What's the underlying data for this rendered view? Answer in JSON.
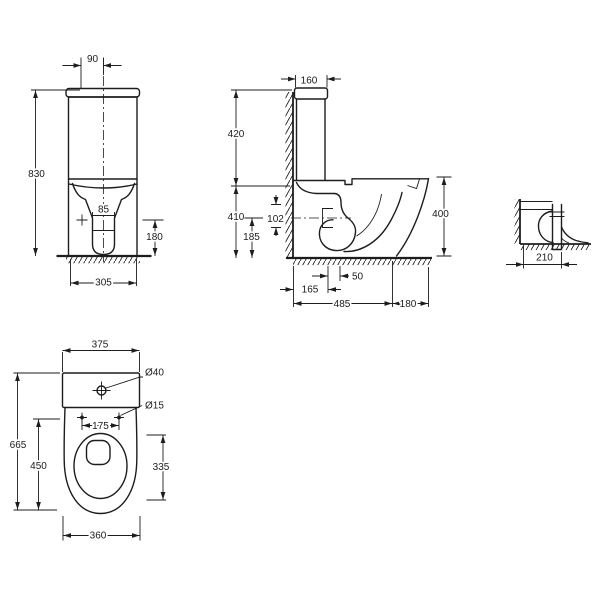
{
  "drawing_title": "toilet-technical-drawing",
  "colors": {
    "line": "#1d1d1d",
    "background": "#ffffff"
  },
  "views": {
    "front": {
      "dims": {
        "inlet_offset": "90",
        "overall_height": "830",
        "trapway_width": "85",
        "outlet_height": "180",
        "base_width": "305"
      }
    },
    "side": {
      "dims": {
        "cistern_depth": "160",
        "cistern_top_height": "420",
        "seat_height": "410",
        "outlet_offset": "102",
        "outlet_center_height": "185",
        "front_height": "400",
        "outlet_setback": "50",
        "wall_to_outlet": "165",
        "wall_to_base_front": "485",
        "base_overhang": "180"
      }
    },
    "outlet_detail": {
      "dims": {
        "wall_to_trap": "210"
      }
    },
    "plan": {
      "dims": {
        "cistern_width": "375",
        "inlet_hole_diameter": "Ø40",
        "fixing_hole_diameter": "Ø15",
        "hole_spacing": "175",
        "overall_length": "665",
        "bowl_length": "450",
        "seat_opening_length": "335",
        "base_width": "360"
      }
    }
  }
}
